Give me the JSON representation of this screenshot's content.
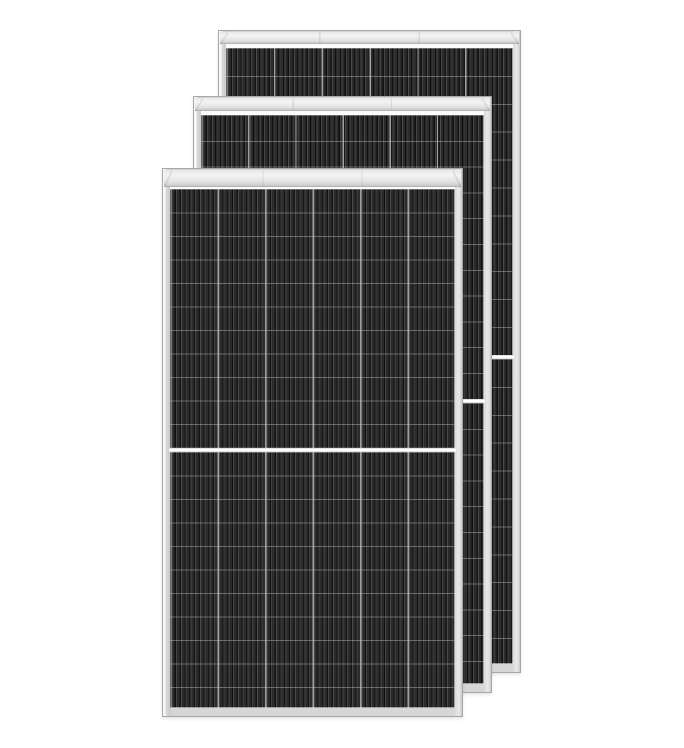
{
  "scene": {
    "type": "product-photo",
    "subject": "Three stacked all-black half-cut-cell solar PV panels with silver aluminium frames on a white background",
    "panel_count": 3,
    "background_color": "#ffffff",
    "image_width": 684,
    "image_height": 748
  },
  "colors": {
    "background": "#ffffff",
    "frame_silver": "#d6d6d6",
    "frame_highlight": "#f8f8f8",
    "frame_edge": "#a7a7a7",
    "head_bar_light": "#f4f4f4",
    "head_bar_shadow": "#c2c2c2",
    "cell_body": "#2c2c2c",
    "cell_stripe_dark": "#0e0e0e",
    "column_divider": "#a8a8a8",
    "row_divider": "#cdcdcd",
    "center_split": "#ffffff"
  },
  "panels": [
    {
      "id": "back",
      "left": 218,
      "top": 30,
      "width": 303,
      "height": 643,
      "head_height": 12,
      "cells_top": 17,
      "half_height": 307,
      "row_height": 27.9,
      "columns": 6,
      "rows_per_half": 11
    },
    {
      "id": "middle",
      "left": 193,
      "top": 96,
      "width": 299,
      "height": 597,
      "head_height": 13,
      "cells_top": 18,
      "half_height": 283.5,
      "row_height": 25.8,
      "columns": 6,
      "rows_per_half": 11
    },
    {
      "id": "front",
      "left": 162,
      "top": 168,
      "width": 301,
      "height": 549,
      "head_height": 17,
      "cells_top": 20,
      "half_height": 258.5,
      "row_height": 23.5,
      "columns": 6,
      "rows_per_half": 11
    }
  ]
}
